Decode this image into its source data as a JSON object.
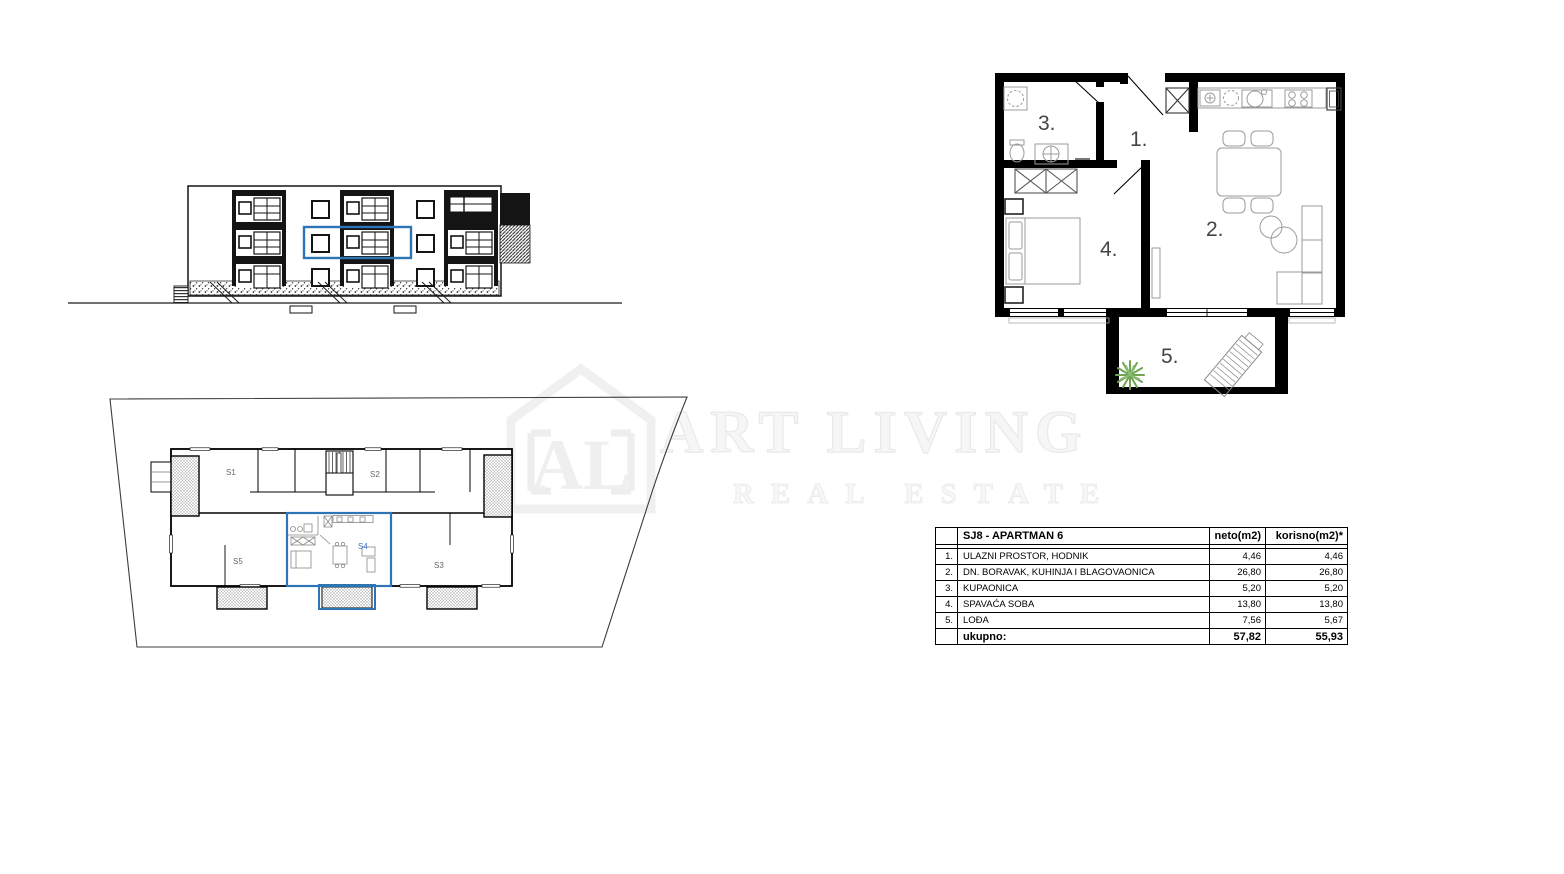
{
  "watermark": {
    "line1": "ART LIVING",
    "line2": "REAL ESTATE",
    "logo_text": "AL",
    "color": "#f0f0f0"
  },
  "elevation": {
    "highlight_color": "#2e75b6"
  },
  "site_plan": {
    "highlight_color": "#2e75b6",
    "highlighted_unit": "S4",
    "units": {
      "s1": "S1",
      "s2": "S2",
      "s3": "S3",
      "s4": "S4",
      "s5": "S5"
    }
  },
  "floor_plan": {
    "rooms": {
      "hallway": "1.",
      "living": "2.",
      "bathroom": "3.",
      "bedroom": "4.",
      "loggia": "5."
    }
  },
  "area_table": {
    "title": "SJ8 - APARTMAN 6",
    "col_neto": "neto(m2)",
    "col_korisno": "korisno(m2)*",
    "rows": [
      {
        "num": "1.",
        "name": "ULAZNI PROSTOR, HODNIK",
        "neto": "4,46",
        "korisno": "4,46"
      },
      {
        "num": "2.",
        "name": "DN. BORAVAK, KUHINJA I BLAGOVAONICA",
        "neto": "26,80",
        "korisno": "26,80"
      },
      {
        "num": "3.",
        "name": "KUPAONICA",
        "neto": "5,20",
        "korisno": "5,20"
      },
      {
        "num": "4.",
        "name": "SPAVAĆA SOBA",
        "neto": "13,80",
        "korisno": "13,80"
      },
      {
        "num": "5.",
        "name": "LOĐA",
        "neto": "7,56",
        "korisno": "5,67"
      }
    ],
    "total": {
      "label": "ukupno:",
      "neto": "57,82",
      "korisno": "55,93"
    }
  }
}
